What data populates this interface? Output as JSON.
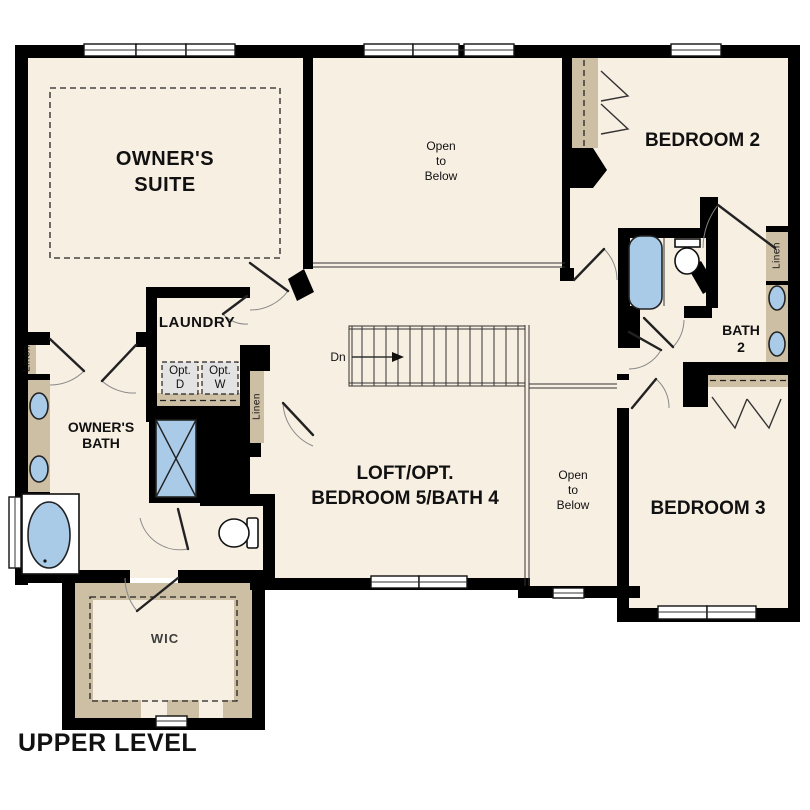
{
  "plan_title": "UPPER LEVEL",
  "colors": {
    "wall": "#000000",
    "floor": "#f8efe3",
    "cabinet": "#cdbfa4",
    "fixture": "#a9cbe8",
    "opt_box": "#e3e3e3",
    "text": "#111111"
  },
  "rooms": {
    "owners_suite": {
      "lines": [
        "OWNER'S",
        "SUITE"
      ]
    },
    "open_to_below_top": {
      "lines": [
        "Open",
        "to",
        "Below"
      ]
    },
    "bedroom_2": {
      "label": "BEDROOM 2"
    },
    "laundry": {
      "label": "LAUNDRY"
    },
    "owners_bath": {
      "lines": [
        "OWNER'S",
        "BATH"
      ]
    },
    "bath_2": {
      "lines": [
        "BATH",
        "2"
      ]
    },
    "loft": {
      "lines": [
        "LOFT/OPT.",
        "BEDROOM 5/BATH 4"
      ]
    },
    "open_to_below_mid": {
      "lines": [
        "Open",
        "to",
        "Below"
      ]
    },
    "bedroom_3": {
      "label": "BEDROOM 3"
    },
    "wic": {
      "label": "WIC"
    }
  },
  "labels": {
    "linen": "Linen",
    "down": "Dn",
    "opt_dryer": {
      "lines": [
        "Opt.",
        "D"
      ]
    },
    "opt_washer": {
      "lines": [
        "Opt.",
        "W"
      ]
    }
  }
}
